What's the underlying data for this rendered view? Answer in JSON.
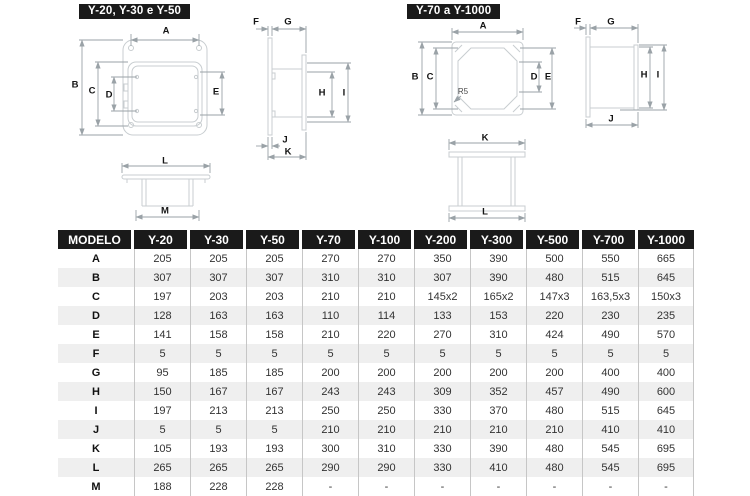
{
  "diagrams": {
    "left": {
      "title": "Y-20, Y-30 e Y-50",
      "dim_labels": [
        "A",
        "B",
        "C",
        "D",
        "E",
        "F",
        "G",
        "H",
        "I",
        "J",
        "K",
        "L",
        "M"
      ]
    },
    "right": {
      "title": "Y-70 a Y-1000",
      "dim_labels": [
        "A",
        "B",
        "C",
        "D",
        "E",
        "F",
        "G",
        "H",
        "I",
        "J",
        "K",
        "L"
      ],
      "radius_note": "R5"
    }
  },
  "table": {
    "header": [
      "MODELO",
      "Y-20",
      "Y-30",
      "Y-50",
      "Y-70",
      "Y-100",
      "Y-200",
      "Y-300",
      "Y-500",
      "Y-700",
      "Y-1000"
    ],
    "rows": [
      {
        "label": "A",
        "values": [
          "205",
          "205",
          "205",
          "270",
          "270",
          "350",
          "390",
          "500",
          "550",
          "665"
        ]
      },
      {
        "label": "B",
        "values": [
          "307",
          "307",
          "307",
          "310",
          "310",
          "307",
          "390",
          "480",
          "515",
          "645"
        ]
      },
      {
        "label": "C",
        "values": [
          "197",
          "203",
          "203",
          "210",
          "210",
          "145x2",
          "165x2",
          "147x3",
          "163,5x3",
          "150x3"
        ]
      },
      {
        "label": "D",
        "values": [
          "128",
          "163",
          "163",
          "110",
          "114",
          "133",
          "153",
          "220",
          "230",
          "235"
        ]
      },
      {
        "label": "E",
        "values": [
          "141",
          "158",
          "158",
          "210",
          "220",
          "270",
          "310",
          "424",
          "490",
          "570"
        ]
      },
      {
        "label": "F",
        "values": [
          "5",
          "5",
          "5",
          "5",
          "5",
          "5",
          "5",
          "5",
          "5",
          "5"
        ]
      },
      {
        "label": "G",
        "values": [
          "95",
          "185",
          "185",
          "200",
          "200",
          "200",
          "200",
          "200",
          "400",
          "400"
        ]
      },
      {
        "label": "H",
        "values": [
          "150",
          "167",
          "167",
          "243",
          "243",
          "309",
          "352",
          "457",
          "490",
          "600"
        ]
      },
      {
        "label": "I",
        "values": [
          "197",
          "213",
          "213",
          "250",
          "250",
          "330",
          "370",
          "480",
          "515",
          "645"
        ]
      },
      {
        "label": "J",
        "values": [
          "5",
          "5",
          "5",
          "210",
          "210",
          "210",
          "210",
          "210",
          "410",
          "410"
        ]
      },
      {
        "label": "K",
        "values": [
          "105",
          "193",
          "193",
          "300",
          "310",
          "330",
          "390",
          "480",
          "545",
          "695"
        ]
      },
      {
        "label": "L",
        "values": [
          "265",
          "265",
          "265",
          "290",
          "290",
          "330",
          "410",
          "480",
          "545",
          "695"
        ]
      },
      {
        "label": "M",
        "values": [
          "188",
          "228",
          "228",
          "-",
          "-",
          "-",
          "-",
          "-",
          "-",
          "-"
        ]
      }
    ]
  },
  "colors": {
    "badge_bg": "#1a1a1a",
    "badge_text": "#ffffff",
    "table_header_bg": "#1a1a1a",
    "row_alt": "#efefef",
    "outline": "#c8cdd0",
    "dimension_line": "#9aa2a7"
  }
}
